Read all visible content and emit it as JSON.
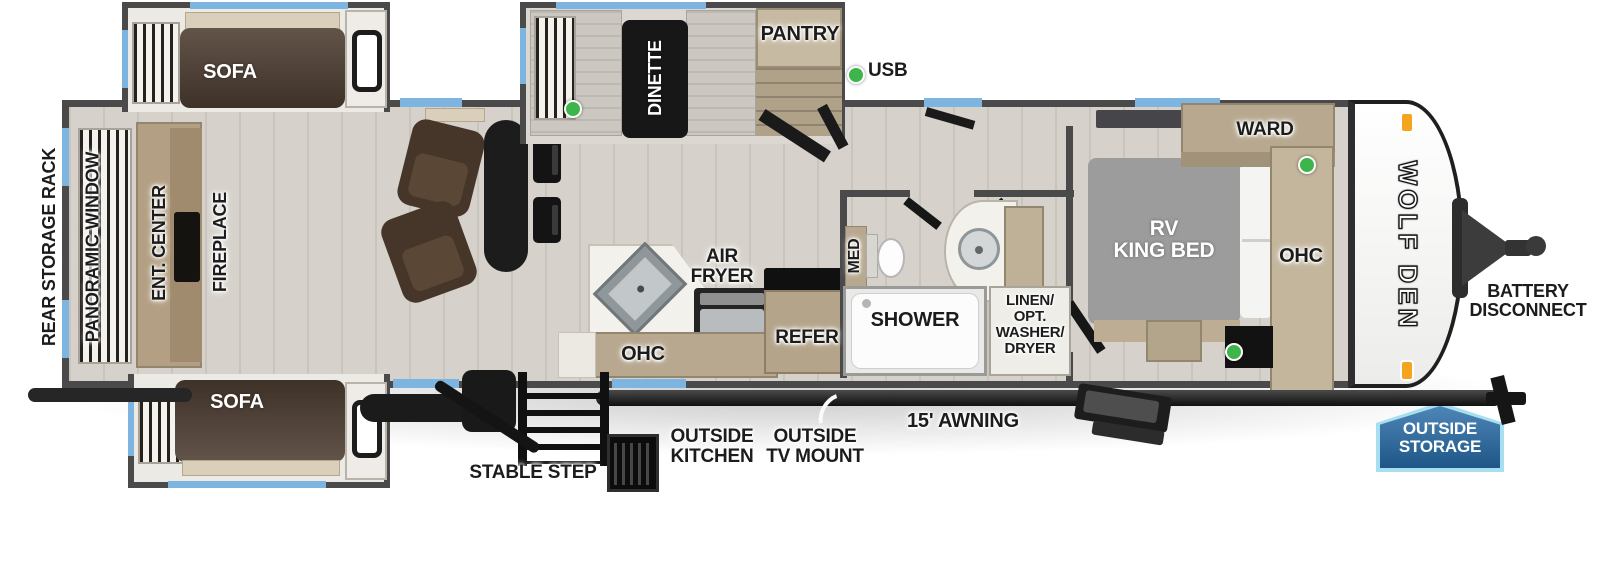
{
  "colors": {
    "wall": "#4a4a4a",
    "floor": "#d6d2cb",
    "accent_blue": "#7db4e0",
    "cabinet_tan": "#b7a88f",
    "sofa_brown": "#4c3c30",
    "usb_green": "#3db54a",
    "badge_blue": "#2f6ea8",
    "marker_orange": "#f5a51d"
  },
  "legend": {
    "usb": "USB"
  },
  "rear": {
    "storage_rack": "REAR STORAGE RACK",
    "panoramic_window": "PANORAMIC WINDOW",
    "ent_center": "ENT. CENTER",
    "fireplace": "FIREPLACE"
  },
  "living": {
    "sofa_top": "SOFA",
    "sofa_bottom": "SOFA"
  },
  "dinette_area": {
    "dinette": "DINETTE",
    "pantry": "PANTRY"
  },
  "kitchen": {
    "air_fryer": "AIR\nFRYER",
    "ohc": "OHC",
    "refer": "REFER"
  },
  "bath": {
    "med": "MED",
    "shower": "SHOWER",
    "linen_closet": "LINEN/\nOPT.\nWASHER/\nDRYER"
  },
  "bedroom": {
    "bed": "RV\nKING BED",
    "ward": "WARD",
    "ohc": "OHC"
  },
  "front": {
    "logo": "WOLF DEN",
    "battery_disconnect": "BATTERY\nDISCONNECT",
    "outside_storage": "OUTSIDE\nSTORAGE"
  },
  "exterior": {
    "stable_step": "STABLE STEP",
    "outside_kitchen": "OUTSIDE\nKITCHEN",
    "outside_tv_mount": "OUTSIDE\nTV MOUNT",
    "awning": "15' AWNING"
  }
}
